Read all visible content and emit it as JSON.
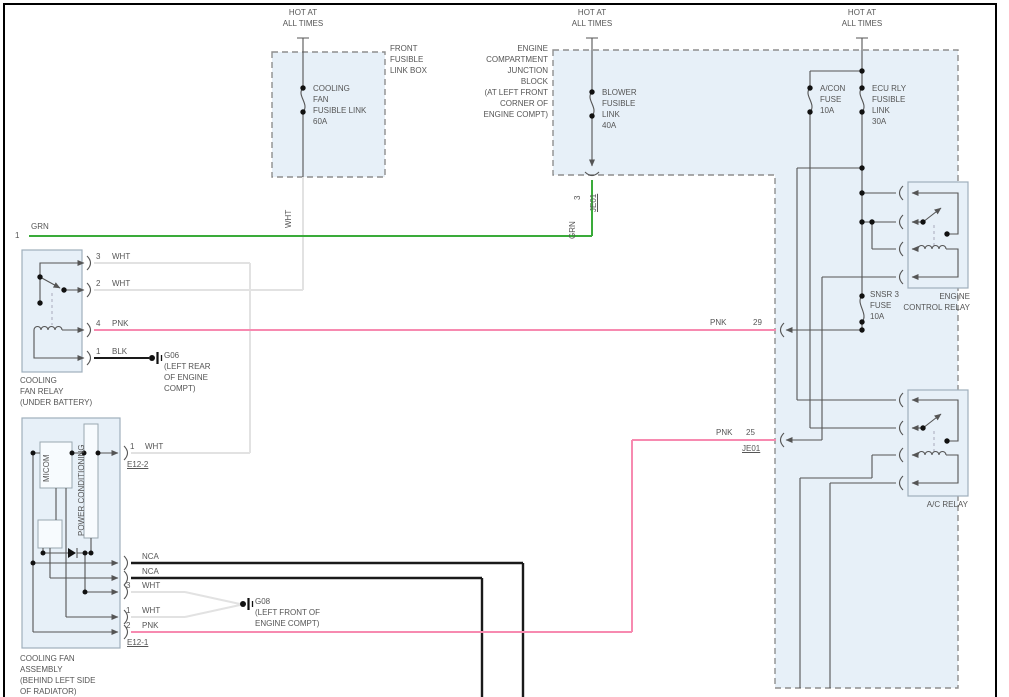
{
  "colors": {
    "green_wire": "#3aab3a",
    "pink_wire": "#f78ab0",
    "white_wire": "#e2e2e2",
    "black_wire": "#1a1a1a",
    "box_fill": "#e7f0f8",
    "dash_border": "#8e8e8e",
    "wire_gray": "#555555",
    "text": "#555555"
  },
  "power_labels": {
    "line1": "HOT AT",
    "line2": "ALL TIMES"
  },
  "front_box": {
    "name": [
      "FRONT",
      "FUSIBLE",
      "LINK BOX"
    ],
    "fuse": [
      "COOLING",
      "FAN",
      "FUSIBLE LINK",
      "60A"
    ]
  },
  "junction_block": {
    "name": [
      "ENGINE",
      "COMPARTMENT",
      "JUNCTION",
      "BLOCK",
      "(AT LEFT FRONT",
      "CORNER OF",
      "ENGINE COMPT)"
    ],
    "blower_fuse": [
      "BLOWER",
      "FUSIBLE",
      "LINK",
      "40A"
    ],
    "acon_fuse": [
      "A/CON",
      "FUSE",
      "10A"
    ],
    "ecu_fuse": [
      "ECU RLY",
      "FUSIBLE",
      "LINK",
      "30A"
    ],
    "snsr_fuse": [
      "SNSR 3",
      "FUSE",
      "10A"
    ],
    "pin3": "3",
    "pin29": "29",
    "pin25": "25",
    "je01": "JE01"
  },
  "relays": {
    "engine_control": [
      "ENGINE",
      "CONTROL RELAY"
    ],
    "ac": "A/C RELAY"
  },
  "fan_relay": {
    "name": [
      "COOLING",
      "FAN RELAY",
      "(UNDER BATTERY)"
    ],
    "pins": [
      {
        "n": "3",
        "c": "WHT"
      },
      {
        "n": "2",
        "c": "WHT"
      },
      {
        "n": "4",
        "c": "PNK"
      },
      {
        "n": "1",
        "c": "BLK"
      }
    ]
  },
  "fan_assembly": {
    "name": [
      "COOLING FAN",
      "ASSEMBLY",
      "(BEHIND LEFT SIDE",
      "OF RADIATOR)"
    ],
    "micom": "MICOM",
    "power_cond": "POWER CONDITIONING",
    "e12_2": "E12-2",
    "e12_1": "E12-1",
    "pin_e12_2": {
      "n": "1",
      "c": "WHT"
    },
    "pins": [
      {
        "c": "NCA"
      },
      {
        "c": "NCA"
      },
      {
        "n": "3",
        "c": "WHT"
      },
      {
        "n": "1",
        "c": "WHT"
      },
      {
        "n": "2",
        "c": "PNK"
      }
    ]
  },
  "grounds": {
    "g06": [
      "G06",
      "(LEFT REAR",
      "OF ENGINE",
      "COMPT)"
    ],
    "g08": [
      "G08",
      "(LEFT FRONT OF",
      "ENGINE COMPT)"
    ]
  },
  "wires": {
    "grn": "GRN",
    "wht": "WHT",
    "pnk": "PNK",
    "circuit_num": "1"
  }
}
